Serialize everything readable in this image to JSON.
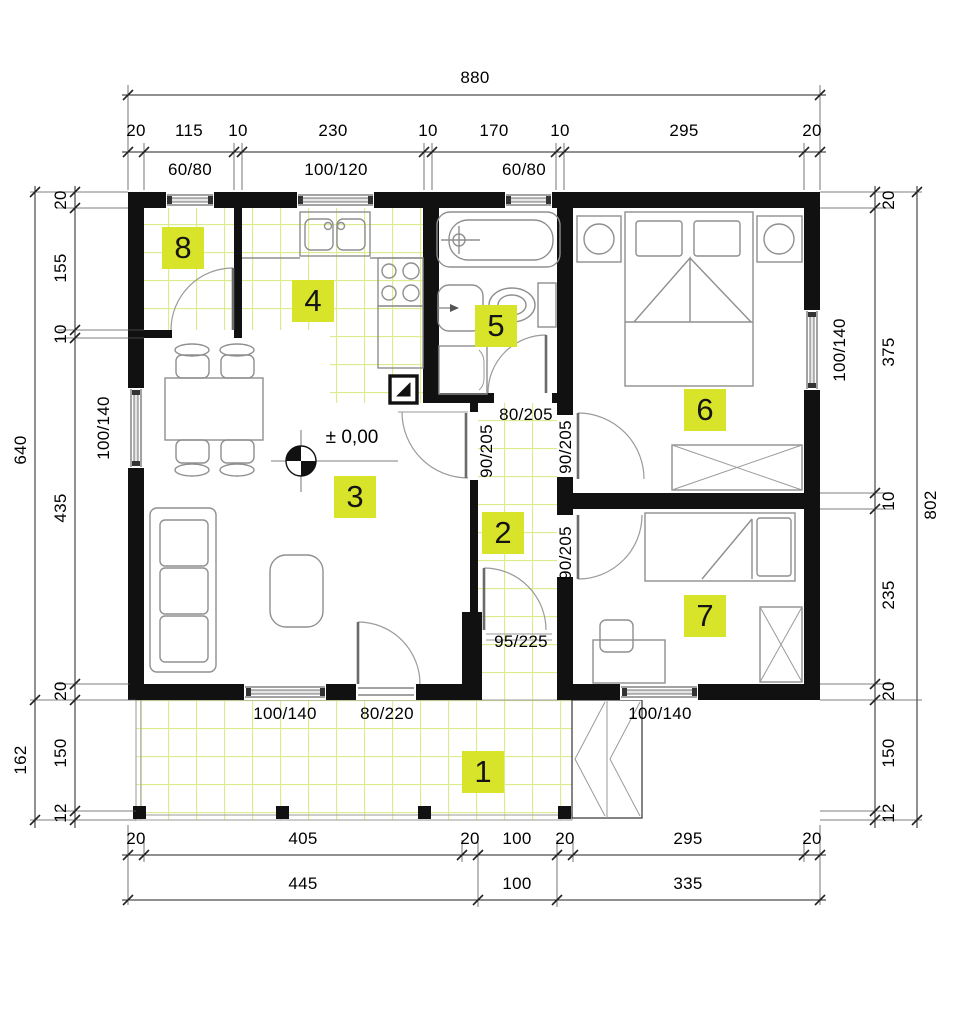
{
  "colors": {
    "wall": "#111111",
    "label_bg": "#d7e42a",
    "tile_line": "#d9ec8e",
    "furniture_line": "#8f8f8f"
  },
  "level_mark": {
    "label": "± 0,00"
  },
  "rooms": [
    {
      "number": "1"
    },
    {
      "number": "2"
    },
    {
      "number": "3"
    },
    {
      "number": "4"
    },
    {
      "number": "5"
    },
    {
      "number": "6"
    },
    {
      "number": "7"
    },
    {
      "number": "8"
    }
  ],
  "dims": {
    "top": {
      "overall": "880",
      "chain": [
        "20",
        "115",
        "10",
        "230",
        "10",
        "170",
        "10",
        "295",
        "20"
      ],
      "windows": [
        "60/80",
        "100/120",
        "60/80"
      ]
    },
    "bottom": {
      "chain": [
        "20",
        "405",
        "20",
        "100",
        "20",
        "295",
        "20"
      ],
      "outer": [
        "445",
        "100",
        "335"
      ],
      "openings": [
        "100/140",
        "80/220",
        "100/140"
      ]
    },
    "left": {
      "overall": "640",
      "terrace_overall": "162",
      "chain": [
        "20",
        "155",
        "10",
        "435",
        "20"
      ],
      "terrace_chain": [
        "150",
        "12"
      ],
      "window": "100/140"
    },
    "right": {
      "overall": "802",
      "chain": [
        "20",
        "375",
        "10",
        "235",
        "20"
      ],
      "terrace_chain": [
        "150",
        "12"
      ],
      "window": "100/140"
    }
  },
  "interior": {
    "bath_door": "80/205",
    "hall_living_door": "90/205",
    "bed6_door": "90/205",
    "bed7_door": "90/205",
    "entrance_door": "95/225"
  }
}
